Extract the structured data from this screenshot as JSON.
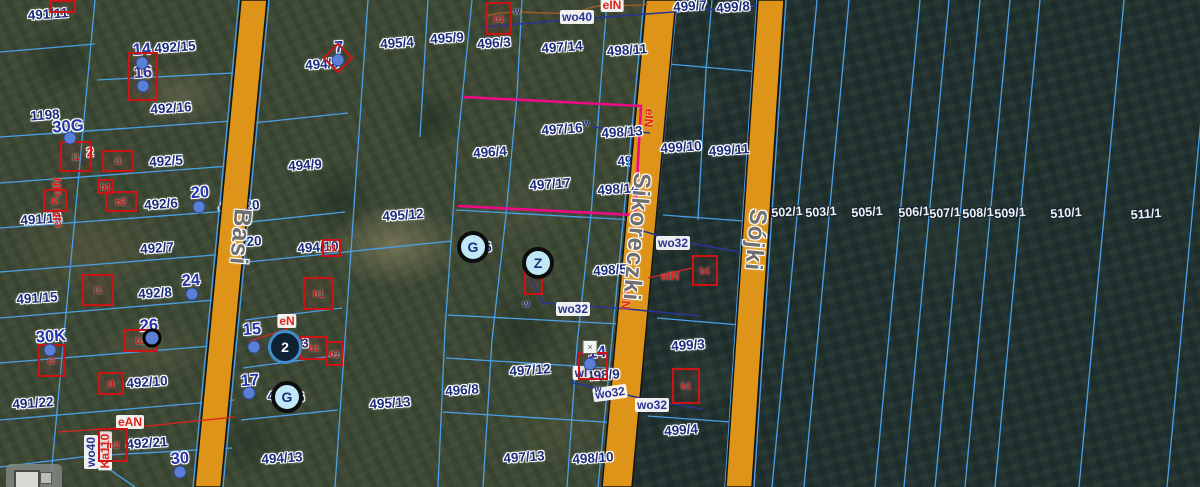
{
  "map": {
    "streets": [
      {
        "name": "Basi",
        "x": 240,
        "y": 237,
        "size": 25
      },
      {
        "name": "Sikoreczki",
        "x": 636,
        "y": 237,
        "size": 24
      },
      {
        "name": "Sójki",
        "x": 755,
        "y": 240,
        "size": 24
      }
    ],
    "parcel_labels": [
      {
        "t": "491/11",
        "x": 48,
        "y": 14
      },
      {
        "t": "492/15",
        "x": 175,
        "y": 47
      },
      {
        "t": "1198",
        "x": 45,
        "y": 115
      },
      {
        "t": "492/16",
        "x": 171,
        "y": 108
      },
      {
        "t": "492/5",
        "x": 166,
        "y": 161
      },
      {
        "t": "492/6",
        "x": 161,
        "y": 204
      },
      {
        "t": "491/14",
        "x": 41,
        "y": 219
      },
      {
        "t": "492/7",
        "x": 157,
        "y": 248
      },
      {
        "t": "492/8",
        "x": 155,
        "y": 293
      },
      {
        "t": "491/15",
        "x": 37,
        "y": 298
      },
      {
        "t": "492/10",
        "x": 147,
        "y": 382
      },
      {
        "t": "491/22",
        "x": 33,
        "y": 403
      },
      {
        "t": "492/21",
        "x": 147,
        "y": 443
      },
      {
        "t": "494/8",
        "x": 322,
        "y": 64
      },
      {
        "t": "494/9",
        "x": 305,
        "y": 165
      },
      {
        "t": "494/10",
        "x": 318,
        "y": 247
      },
      {
        "t": "494/13",
        "x": 282,
        "y": 458
      },
      {
        "t": "495/4",
        "x": 397,
        "y": 43
      },
      {
        "t": "495/9",
        "x": 447,
        "y": 38
      },
      {
        "t": "495/12",
        "x": 403,
        "y": 215
      },
      {
        "t": "495/13",
        "x": 390,
        "y": 403
      },
      {
        "t": "496/3",
        "x": 494,
        "y": 43
      },
      {
        "t": "496/4",
        "x": 490,
        "y": 152
      },
      {
        "t": "496/8",
        "x": 462,
        "y": 390
      },
      {
        "t": "497/14",
        "x": 562,
        "y": 47
      },
      {
        "t": "497/16",
        "x": 562,
        "y": 129
      },
      {
        "t": "497/17",
        "x": 550,
        "y": 184
      },
      {
        "t": "497/12",
        "x": 530,
        "y": 370
      },
      {
        "t": "497/13",
        "x": 524,
        "y": 457
      },
      {
        "t": "498/11",
        "x": 627,
        "y": 50
      },
      {
        "t": "498/13",
        "x": 622,
        "y": 132
      },
      {
        "t": "498/14",
        "x": 618,
        "y": 189
      },
      {
        "t": "498/5",
        "x": 610,
        "y": 270
      },
      {
        "t": "498/9",
        "x": 603,
        "y": 375
      },
      {
        "t": "498/10",
        "x": 593,
        "y": 458
      },
      {
        "t": "499/7",
        "x": 690,
        "y": 6
      },
      {
        "t": "499/8",
        "x": 733,
        "y": 7
      },
      {
        "t": "499/10",
        "x": 681,
        "y": 147
      },
      {
        "t": "499/11",
        "x": 729,
        "y": 150
      },
      {
        "t": "499/3",
        "x": 688,
        "y": 345
      },
      {
        "t": "499/4",
        "x": 681,
        "y": 430
      }
    ],
    "under_road_labels": [
      {
        "t": "494/20",
        "x": 241,
        "y": 242
      },
      {
        "t": "494/20",
        "x": 239,
        "y": 206
      },
      {
        "t": "498/17",
        "x": 638,
        "y": 160
      }
    ],
    "forest_labels": [
      {
        "t": "502/1",
        "x": 787,
        "y": 212
      },
      {
        "t": "503/1",
        "x": 821,
        "y": 212
      },
      {
        "t": "505/1",
        "x": 867,
        "y": 212
      },
      {
        "t": "506/1",
        "x": 914,
        "y": 212
      },
      {
        "t": "507/1",
        "x": 945,
        "y": 213
      },
      {
        "t": "508/1",
        "x": 978,
        "y": 213
      },
      {
        "t": "509/1",
        "x": 1010,
        "y": 213
      },
      {
        "t": "510/1",
        "x": 1066,
        "y": 213
      },
      {
        "t": "511/1",
        "x": 1146,
        "y": 214
      }
    ],
    "address_labels": [
      {
        "t": "14",
        "x": 142,
        "y": 50
      },
      {
        "t": "16",
        "x": 143,
        "y": 73
      },
      {
        "t": "30G",
        "x": 68,
        "y": 127
      },
      {
        "t": "20",
        "x": 200,
        "y": 193
      },
      {
        "t": "24",
        "x": 191,
        "y": 281
      },
      {
        "t": "26",
        "x": 149,
        "y": 326
      },
      {
        "t": "30K",
        "x": 51,
        "y": 337
      },
      {
        "t": "30",
        "x": 180,
        "y": 459
      },
      {
        "t": "15",
        "x": 252,
        "y": 330
      },
      {
        "t": "17",
        "x": 250,
        "y": 381
      },
      {
        "t": "7",
        "x": 339,
        "y": 48
      },
      {
        "t": "14",
        "x": 597,
        "y": 353
      }
    ],
    "fragments": [
      {
        "t": "4",
        "x": 463,
        "y": 246
      },
      {
        "t": "6",
        "x": 488,
        "y": 247
      },
      {
        "t": "4",
        "x": 271,
        "y": 396
      },
      {
        "t": "6",
        "x": 301,
        "y": 397
      },
      {
        "t": "4",
        "x": 276,
        "y": 342
      },
      {
        "t": "3",
        "x": 305,
        "y": 343
      }
    ],
    "red_fragments": [
      {
        "t": "2",
        "x": 90,
        "y": 152
      }
    ],
    "utility_labels": [
      {
        "t": "wo40",
        "x": 577,
        "y": 17,
        "k": "w"
      },
      {
        "t": "wo32",
        "x": 673,
        "y": 243,
        "k": "w"
      },
      {
        "t": "wo32",
        "x": 573,
        "y": 309,
        "k": "w"
      },
      {
        "t": "wo32",
        "x": 610,
        "y": 393,
        "k": "w",
        "rot": -8
      },
      {
        "t": "wo32",
        "x": 652,
        "y": 405,
        "k": "w"
      },
      {
        "t": "wl",
        "x": 581,
        "y": 373,
        "k": "w"
      },
      {
        "t": "wo40",
        "x": 91,
        "y": 452,
        "k": "w",
        "rot": -90
      },
      {
        "t": "Ka110",
        "x": 105,
        "y": 451,
        "k": "e",
        "rot": -90
      },
      {
        "t": "eIN",
        "x": 612,
        "y": 5,
        "k": "e"
      },
      {
        "t": "eIN",
        "x": 670,
        "y": 276,
        "k": "e",
        "bare": true
      },
      {
        "t": "eN",
        "x": 287,
        "y": 321,
        "k": "e"
      },
      {
        "t": "eAN",
        "x": 130,
        "y": 422,
        "k": "e"
      },
      {
        "t": "eIN",
        "x": 649,
        "y": 118,
        "k": "e",
        "rot": 95,
        "bare": true
      },
      {
        "t": "eIN",
        "x": 626,
        "y": 300,
        "k": "e",
        "rot": 95,
        "bare": true
      },
      {
        "t": "eIN",
        "x": 57,
        "y": 187,
        "k": "e",
        "rot": -90,
        "bare": true
      },
      {
        "t": "eIN",
        "x": 57,
        "y": 218,
        "k": "e",
        "rot": -90,
        "bare": true
      }
    ],
    "water_ticks": [
      {
        "t": "w",
        "x": 517,
        "y": 11
      },
      {
        "t": "w",
        "x": 586,
        "y": 123
      },
      {
        "t": "w",
        "x": 526,
        "y": 304
      },
      {
        "t": "w",
        "x": 598,
        "y": 389
      }
    ],
    "poi_markers": [
      {
        "t": "G",
        "x": 473,
        "y": 247
      },
      {
        "t": "G",
        "x": 287,
        "y": 397
      },
      {
        "t": "Z",
        "x": 538,
        "y": 263
      }
    ],
    "cluster_marker": {
      "t": "2",
      "x": 285,
      "y": 347
    },
    "ring_dot": {
      "x": 152,
      "y": 338
    },
    "symbol_box": {
      "t": "×",
      "x": 590,
      "y": 347
    },
    "diamond_marker": {
      "x": 338,
      "y": 58
    },
    "address_dots": [
      [
        142,
        63
      ],
      [
        143,
        86
      ],
      [
        70,
        138
      ],
      [
        199,
        207
      ],
      [
        192,
        294
      ],
      [
        50,
        350
      ],
      [
        180,
        472
      ],
      [
        254,
        347
      ],
      [
        249,
        393
      ],
      [
        338,
        60
      ],
      [
        590,
        364
      ]
    ],
    "buildings": [
      {
        "x": 50,
        "y": 0,
        "w": 22,
        "h": 9,
        "t": ""
      },
      {
        "x": 128,
        "y": 52,
        "w": 26,
        "h": 45,
        "t": ""
      },
      {
        "x": 60,
        "y": 141,
        "w": 28,
        "h": 27,
        "t": "i1"
      },
      {
        "x": 43,
        "y": 189,
        "w": 20,
        "h": 19,
        "t": "i2"
      },
      {
        "x": 102,
        "y": 150,
        "w": 28,
        "h": 18,
        "t": "i1"
      },
      {
        "x": 97,
        "y": 179,
        "w": 13,
        "h": 11,
        "t": "b1"
      },
      {
        "x": 105,
        "y": 191,
        "w": 28,
        "h": 17,
        "t": "b2"
      },
      {
        "x": 82,
        "y": 274,
        "w": 28,
        "h": 28,
        "t": "i1"
      },
      {
        "x": 322,
        "y": 239,
        "w": 15,
        "h": 14,
        "t": "b1"
      },
      {
        "x": 303,
        "y": 277,
        "w": 27,
        "h": 29,
        "t": "b1"
      },
      {
        "x": 486,
        "y": 2,
        "w": 22,
        "h": 29,
        "t": "b1"
      },
      {
        "x": 524,
        "y": 271,
        "w": 15,
        "h": 20,
        "t": ""
      },
      {
        "x": 578,
        "y": 352,
        "w": 26,
        "h": 24,
        "t": ""
      },
      {
        "x": 692,
        "y": 255,
        "w": 22,
        "h": 27,
        "t": "b1"
      },
      {
        "x": 672,
        "y": 368,
        "w": 24,
        "h": 32,
        "t": "b1"
      },
      {
        "x": 98,
        "y": 428,
        "w": 26,
        "h": 30,
        "t": "m2"
      },
      {
        "x": 300,
        "y": 336,
        "w": 24,
        "h": 20,
        "t": "b1"
      },
      {
        "x": 326,
        "y": 341,
        "w": 13,
        "h": 21,
        "t": "b1"
      },
      {
        "x": 124,
        "y": 329,
        "w": 30,
        "h": 19,
        "t": "b1"
      },
      {
        "x": 98,
        "y": 372,
        "w": 22,
        "h": 19,
        "t": "i1"
      },
      {
        "x": 38,
        "y": 344,
        "w": 23,
        "h": 29,
        "t": "i2"
      }
    ],
    "colors": {
      "parcel_line": "#4aa0e8",
      "selection": "#ef0a86",
      "road_fill": "#dd9418",
      "road_edge": "#141414",
      "label_navy": "#1b2d7a",
      "label_white": "#eef0f8",
      "utility_red": "#e02218",
      "water_line": "#283593",
      "power_line": "#9a5a26",
      "street_gray": "#6f6f6f",
      "marker_blue": "#5b7fd4",
      "marker_fill": "#bfe9f7"
    }
  }
}
